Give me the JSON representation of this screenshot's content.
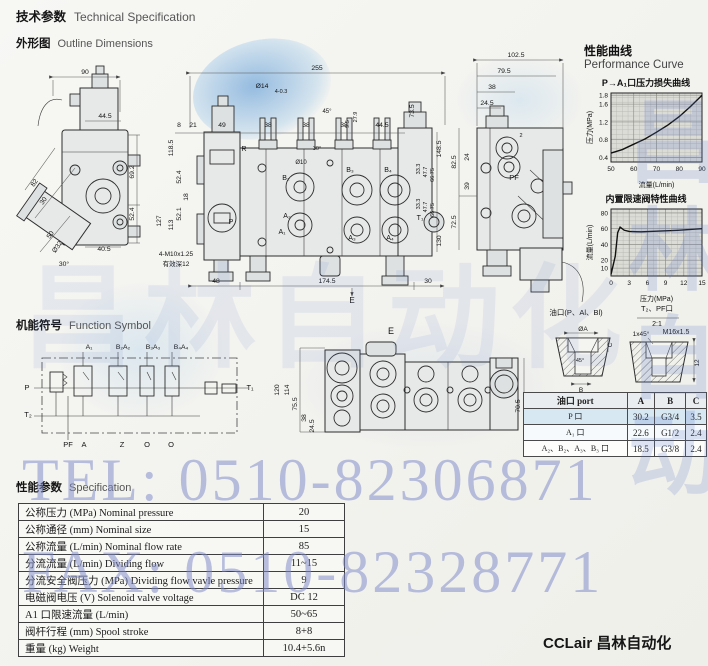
{
  "header": {
    "title_zh": "技术参数",
    "title_en": "Technical Specification"
  },
  "outline": {
    "heading_zh": "外形图",
    "heading_en": "Outline Dimensions",
    "left_view": {
      "ann": [
        [
          85,
          74,
          "90"
        ],
        [
          105,
          118,
          "44.5"
        ],
        [
          134,
          172,
          "69.2",
          -90
        ],
        [
          134,
          214,
          "52.4",
          -90
        ],
        [
          104,
          251,
          "40.5"
        ],
        [
          36,
          184,
          "82",
          -55
        ],
        [
          45,
          202,
          "30",
          -55
        ],
        [
          52,
          236,
          "50",
          -55
        ],
        [
          59,
          248,
          "Ø32",
          -55
        ],
        [
          64,
          266,
          "30°"
        ]
      ]
    },
    "middle_view": {
      "ann": [
        [
          317,
          70,
          "255"
        ],
        [
          179,
          127,
          "8"
        ],
        [
          193,
          127,
          "21"
        ],
        [
          222,
          127,
          "49"
        ],
        [
          268,
          127,
          "38"
        ],
        [
          306,
          127,
          "38"
        ],
        [
          344,
          127,
          "38"
        ],
        [
          382,
          127,
          "44.5"
        ],
        [
          262,
          88,
          "Ø14"
        ],
        [
          281,
          93,
          "4-0.3",
          0,
          5.5
        ],
        [
          327,
          113,
          "45°",
          0,
          6
        ],
        [
          301,
          164,
          "Ø10",
          0,
          6
        ],
        [
          317,
          150,
          "30°",
          0,
          5.5
        ],
        [
          349,
          124,
          "9.5",
          -90,
          5.5
        ],
        [
          357,
          117,
          "27.9",
          -90,
          5.5
        ],
        [
          173,
          148,
          "118.5",
          -90
        ],
        [
          181,
          177,
          "52.4",
          -90
        ],
        [
          188,
          197,
          "18",
          -90
        ],
        [
          181,
          214,
          "52.1",
          -90
        ],
        [
          173,
          225,
          "113",
          -90
        ],
        [
          161,
          221,
          "127",
          -90
        ],
        [
          414,
          111,
          "73.5",
          -90
        ],
        [
          441,
          149,
          "148.5",
          -90
        ],
        [
          441,
          241,
          "130",
          -90
        ],
        [
          420,
          169,
          "33.3",
          -90,
          5.5
        ],
        [
          427,
          172,
          "47.7",
          -90,
          5.5
        ],
        [
          434,
          175,
          "66.75",
          -90,
          5.5
        ],
        [
          420,
          204,
          "33.3",
          -90,
          5.5
        ],
        [
          427,
          207,
          "47.7",
          -90,
          5.5
        ],
        [
          434,
          210,
          "66.75",
          -90,
          5.5
        ],
        [
          216,
          283,
          "48"
        ],
        [
          327,
          283,
          "174.5"
        ],
        [
          428,
          283,
          "30"
        ],
        [
          352,
          303,
          "E",
          0,
          8
        ],
        [
          176,
          256,
          "4-M10x1.25",
          0,
          6.5
        ],
        [
          176,
          266,
          "有效深12",
          0,
          6.5
        ],
        [
          244,
          151,
          "R",
          0,
          7
        ],
        [
          286,
          180,
          "B₂",
          0,
          7
        ],
        [
          287,
          218,
          "A₂",
          0,
          7
        ],
        [
          282,
          234,
          "A₁",
          0,
          7
        ],
        [
          350,
          172,
          "B₃",
          0,
          7
        ],
        [
          388,
          172,
          "B₄",
          0,
          7
        ],
        [
          352,
          240,
          "A₃",
          0,
          7
        ],
        [
          390,
          240,
          "A₄",
          0,
          7
        ],
        [
          231,
          224,
          "P",
          0,
          7
        ],
        [
          420,
          220,
          "T₁",
          0,
          7
        ]
      ]
    },
    "right_view": {
      "ann": [
        [
          516,
          57,
          "102.5"
        ],
        [
          504,
          73,
          "79.5"
        ],
        [
          492,
          89,
          "38"
        ],
        [
          487,
          105,
          "24.5"
        ],
        [
          456,
          162,
          "82.5",
          -90
        ],
        [
          469,
          157,
          "24",
          -90
        ],
        [
          469,
          186,
          "39",
          -90
        ],
        [
          456,
          222,
          "72.5",
          -90
        ],
        [
          514,
          180,
          "PF",
          0,
          7.5
        ],
        [
          521,
          137,
          "2",
          0,
          5.5
        ]
      ]
    },
    "e_view": {
      "ann": [
        [
          391,
          334,
          "E",
          0,
          9
        ],
        [
          279,
          390,
          "120",
          -90
        ],
        [
          289,
          390,
          "114",
          -90
        ],
        [
          297,
          404,
          "75.5",
          -90
        ],
        [
          306,
          418,
          "38",
          -90
        ],
        [
          314,
          426,
          "24.5",
          -90
        ],
        [
          520,
          406,
          "70.5",
          -90
        ]
      ]
    }
  },
  "function_symbol": {
    "heading_zh": "机能符号",
    "heading_en": "Function Symbol",
    "ann": [
      [
        89,
        349,
        "A₁"
      ],
      [
        123,
        349,
        "B₂A₂"
      ],
      [
        153,
        349,
        "B₃A₃"
      ],
      [
        181,
        349,
        "B₄A₄"
      ],
      [
        27,
        390,
        "P",
        0,
        7.5
      ],
      [
        250,
        390,
        "T₁",
        0,
        7.5
      ],
      [
        28,
        417,
        "T₂",
        0,
        7.5
      ],
      [
        68,
        447,
        "PF",
        0,
        7.5
      ],
      [
        84,
        447,
        "A",
        0,
        7.5
      ],
      [
        122,
        447,
        "Z",
        0,
        7.5
      ],
      [
        147,
        447,
        "O",
        0,
        7.5
      ],
      [
        171,
        447,
        "O",
        0,
        7.5
      ]
    ]
  },
  "performance": {
    "heading_zh": "性能曲线",
    "heading_en": "Performance Curve",
    "chart1_title": "P→A₁口压力损失曲线",
    "chart2_title": "内置限速阀特性曲线"
  },
  "chart_data": [
    {
      "type": "line",
      "title": "P→A₁口压力损失曲线",
      "xlabel": "流量(L/min)",
      "ylabel": "压力(MPa)",
      "xlim": [
        50,
        90
      ],
      "ylim": [
        0.3,
        1.85
      ],
      "x_ticks": [
        50,
        60,
        70,
        80,
        90
      ],
      "y_ticks": [
        0.4,
        0.8,
        1.2,
        1.6,
        1.8
      ],
      "minor": [
        16,
        15
      ],
      "grid": "on",
      "legend": "none",
      "points": [
        [
          50,
          0.5
        ],
        [
          55,
          0.58
        ],
        [
          60,
          0.7
        ],
        [
          65,
          0.82
        ],
        [
          70,
          0.97
        ],
        [
          75,
          1.13
        ],
        [
          80,
          1.32
        ],
        [
          85,
          1.55
        ],
        [
          90,
          1.8
        ]
      ]
    },
    {
      "type": "line",
      "title": "内置限速阀特性曲线",
      "xlabel": "压力(MPa)",
      "ylabel": "流量(L/min)",
      "xlim": [
        0,
        15
      ],
      "ylim": [
        0,
        85
      ],
      "x_ticks": [
        0,
        3,
        6,
        9,
        12,
        15
      ],
      "y_ticks": [
        10,
        20,
        40,
        60,
        80
      ],
      "minor": [
        15,
        17
      ],
      "grid": "on",
      "legend": "none",
      "points": [
        [
          0,
          2
        ],
        [
          0.7,
          25
        ],
        [
          1.1,
          55
        ],
        [
          1.5,
          62
        ],
        [
          2.2,
          58
        ],
        [
          3,
          56.5
        ],
        [
          5,
          56
        ],
        [
          8,
          57
        ],
        [
          11,
          58
        ],
        [
          14,
          59.5
        ],
        [
          15,
          60
        ]
      ]
    }
  ],
  "port_section": {
    "ann": [
      [
        576,
        315,
        "油口(P、Al、Bl)",
        0,
        7.5
      ],
      [
        657,
        311,
        "T₂、PF口",
        0,
        7.5
      ],
      [
        657,
        326,
        "2:1",
        0,
        7
      ],
      [
        583,
        331,
        "ØA",
        0,
        6.5
      ],
      [
        612,
        345,
        "C",
        -90,
        6.5
      ],
      [
        580,
        362,
        "45°",
        0,
        5.5
      ],
      [
        581,
        392,
        "B",
        0,
        6.5
      ],
      [
        641,
        336,
        "1x45°",
        0,
        6.5
      ],
      [
        676,
        334,
        "M16x1.5",
        0,
        7
      ],
      [
        699,
        363,
        "12",
        -90,
        6.5
      ]
    ]
  },
  "port_table": {
    "headers": [
      "油口 port",
      "A",
      "B",
      "C"
    ],
    "rows": [
      [
        "P 口",
        "30.2",
        "G3/4",
        "3.5"
      ],
      [
        "A₁ 口",
        "22.6",
        "G1/2",
        "2.4"
      ],
      [
        "A₂、B₂、A₃、B₃ 口",
        "18.5",
        "G3/8",
        "2.4"
      ]
    ]
  },
  "spec": {
    "heading_zh": "性能参数",
    "heading_en": "Specification",
    "rows": [
      {
        "label": "公称压力 (MPa)   Nominal pressure",
        "value": "20"
      },
      {
        "label": "公称通径 (mm)   Nominal size",
        "value": "15"
      },
      {
        "label": "公称流量 (L/min)   Nominal flow rate",
        "value": "85"
      },
      {
        "label": "分流流量 (L/min)   Dividing flow",
        "value": "11~15"
      },
      {
        "label": "分流安全阀压力 (MPa)   Dividing flow vavle pressure",
        "value": "9"
      },
      {
        "label": "电磁阀电压 (V)   Solenoid valve voltage",
        "value": "DC 12"
      },
      {
        "label": "A1 口限速流量 (L/min)",
        "value": "50~65"
      },
      {
        "label": "阀杆行程 (mm)   Spool stroke",
        "value": "8+8"
      },
      {
        "label": "重量 (kg)   Weight",
        "value": "10.4+5.6n"
      }
    ]
  },
  "watermarks": {
    "line1": "TEL: 0510-82306871",
    "line2": "FAX: 0510-82328771",
    "chars_h": "昌林自动化",
    "char1": "昌",
    "char2": "林",
    "char3": "自",
    "char4": "动"
  },
  "footer": {
    "brand": "CCLair 昌林自动化"
  }
}
